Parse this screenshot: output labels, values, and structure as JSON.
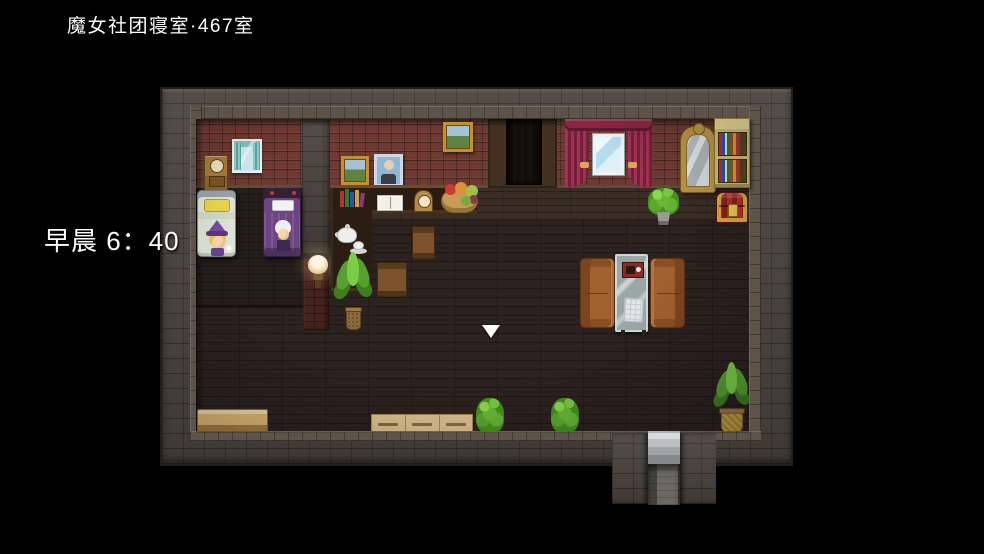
{
  "window": {
    "width": 984,
    "height": 554,
    "background": "#000000"
  },
  "hud": {
    "location": "魔女社团寝室·467室",
    "time": "早晨 6：40",
    "text_color": "#ffffff"
  },
  "scene": {
    "type": "rpg-maker-room-interior",
    "description": "top-down witch club dormitory room with two occupied beds, study counter, sofas and exit stairs",
    "cursor": {
      "shape": "down-triangle",
      "color": "#ffffff",
      "x": 491,
      "y": 331
    },
    "palette": {
      "outer_wall": "#4a423d",
      "red_brick": "#6e3a32",
      "floor": "#2c2220",
      "wood_band": "#3a2d25",
      "curtain_teal": "#7fc7bf",
      "curtain_red": "#8c2644",
      "sofa": "#a06030",
      "chest_gold": "#d8a83c",
      "bookshelf": "#d5bd74",
      "mirror_frame": "#bd9544",
      "plant": "#57a030",
      "bench": "#dcb874",
      "pot_yellow": "#c8a344",
      "cursor": "#ffffff",
      "hud": "#ffffff"
    },
    "objects": [
      "small-curtained-window",
      "clock-cabinet",
      "bed-with-witch",
      "bed-with-white-haired-sleeper",
      "wall-lamp",
      "landscape-paintings",
      "portrait-painting",
      "study-counter",
      "book-spines",
      "open-book",
      "table-clock",
      "fruit-basket",
      "tea-set",
      "chairs",
      "large-potted-plant",
      "curtained-window",
      "ornate-mirror",
      "bookshelf",
      "treasure-chest",
      "two-sofas",
      "glass-table",
      "wooden-bench",
      "wooden-crates",
      "bushes",
      "potted-plants",
      "stairs-exit",
      "doorway"
    ]
  }
}
